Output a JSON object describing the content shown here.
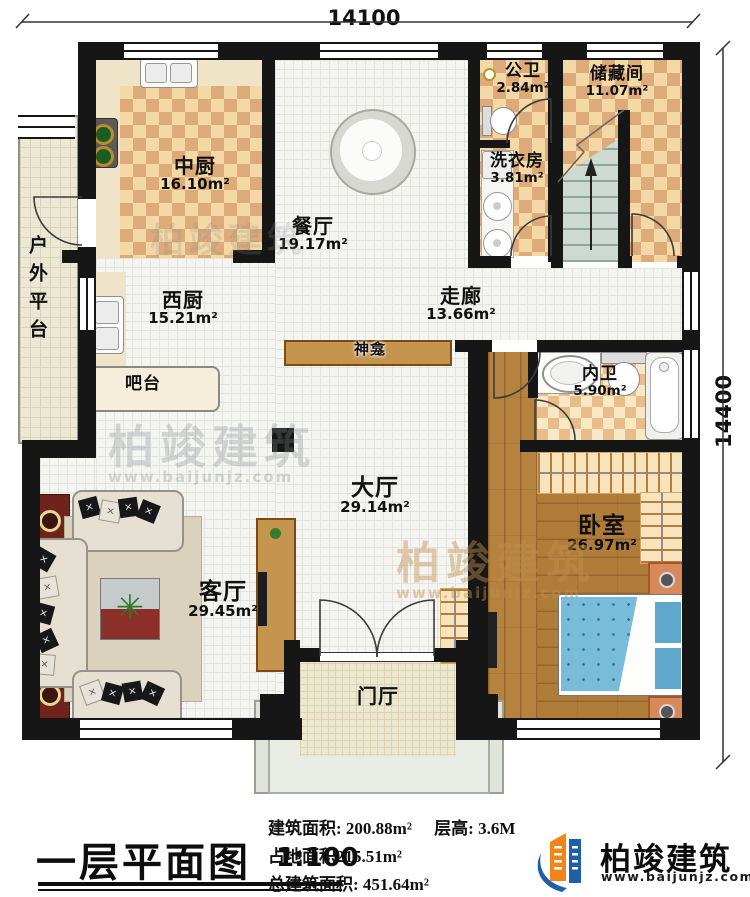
{
  "dimensions": {
    "top": "14100",
    "right": "14400"
  },
  "rooms": [
    {
      "name": "中厨",
      "area": "16.10m²"
    },
    {
      "name": "餐厅",
      "area": "19.17m²"
    },
    {
      "name": "公卫",
      "area": "2.84m²"
    },
    {
      "name": "储藏间",
      "area": "11.07m²"
    },
    {
      "name": "洗衣房",
      "area": "3.81m²"
    },
    {
      "name": "西厨",
      "area": "15.21m²"
    },
    {
      "name": "走廊",
      "area": "13.66m²"
    },
    {
      "name": "内卫",
      "area": "5.90m²"
    },
    {
      "name": "大厅",
      "area": "29.14m²"
    },
    {
      "name": "卧室",
      "area": "26.97m²"
    },
    {
      "name": "客厅",
      "area": "29.45m²"
    }
  ],
  "labels": {
    "outdoor_platform": "户外平台",
    "bar": "吧台",
    "shrine": "神龛",
    "foyer": "门厅"
  },
  "title_block": {
    "title": "一层平面图",
    "scale": "1:100",
    "stat_build": "建筑面积: 200.88m²",
    "stat_height": "层高: 3.6M",
    "stat_land": "占地面积215.51m²",
    "stat_total": "总建筑面积: 451.64m²"
  },
  "logo": {
    "name": "柏竣建筑",
    "website": "www.baijunjz.com"
  },
  "watermark": {
    "text": "柏竣建筑",
    "website": "www.baijunjz.com"
  }
}
